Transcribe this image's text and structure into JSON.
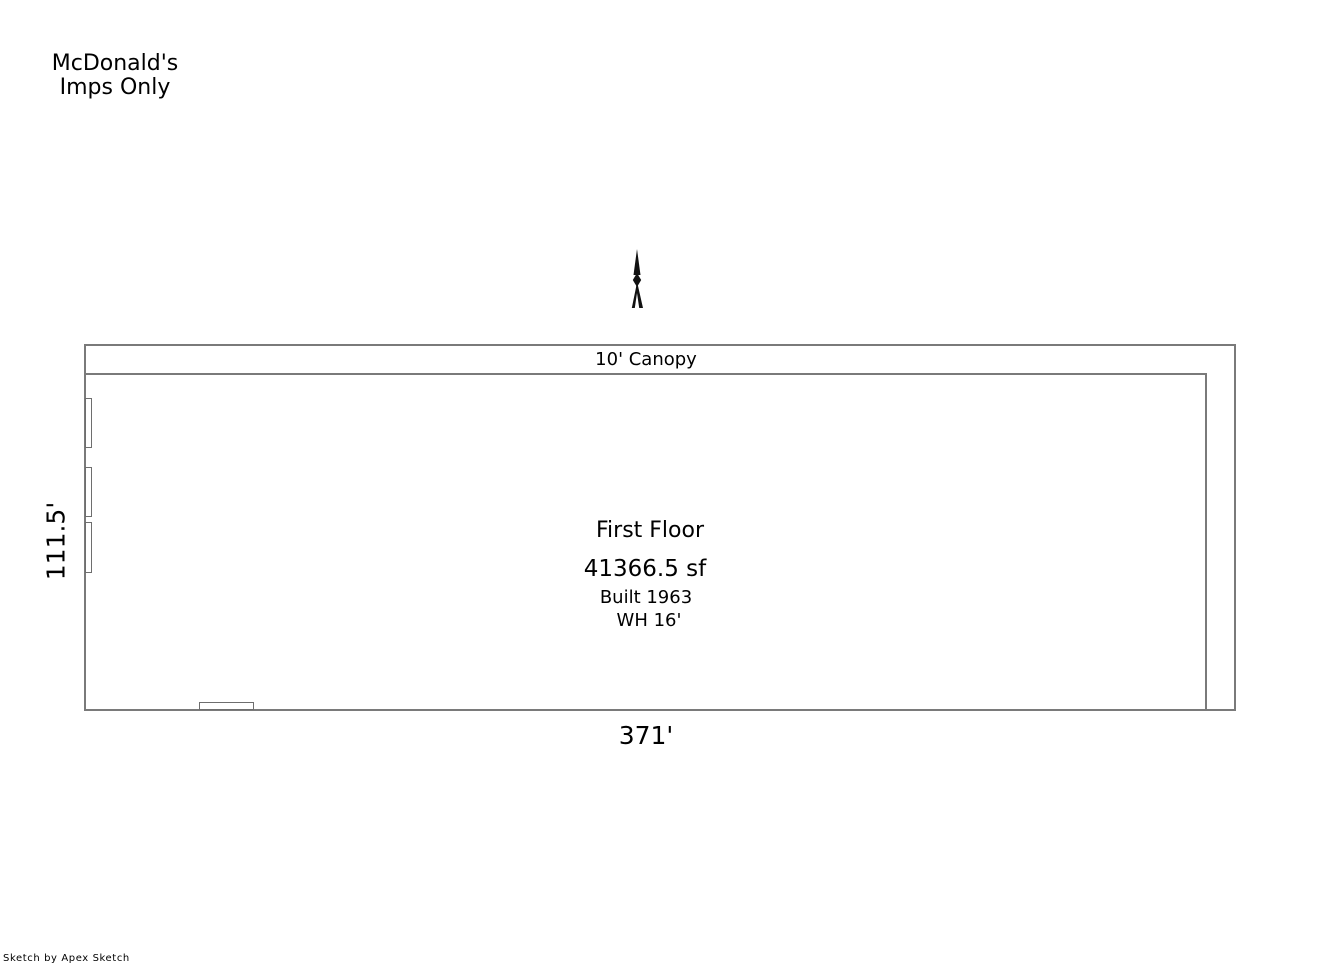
{
  "colors": {
    "background": "#ffffff",
    "wall_line": "#7a7a7a",
    "text": "#000000"
  },
  "header": {
    "line1": "McDonald's",
    "line2": "Imps Only"
  },
  "floorplan": {
    "canopy_label": "10' Canopy",
    "area_title": "First Floor",
    "area_size": "41366.5 sf",
    "built_year": "Built 1963",
    "wall_height": "WH 16'",
    "dim_left": "111.5'",
    "dim_bottom": "371'"
  },
  "footer": {
    "watermark": "Sketch by Apex Sketch"
  }
}
